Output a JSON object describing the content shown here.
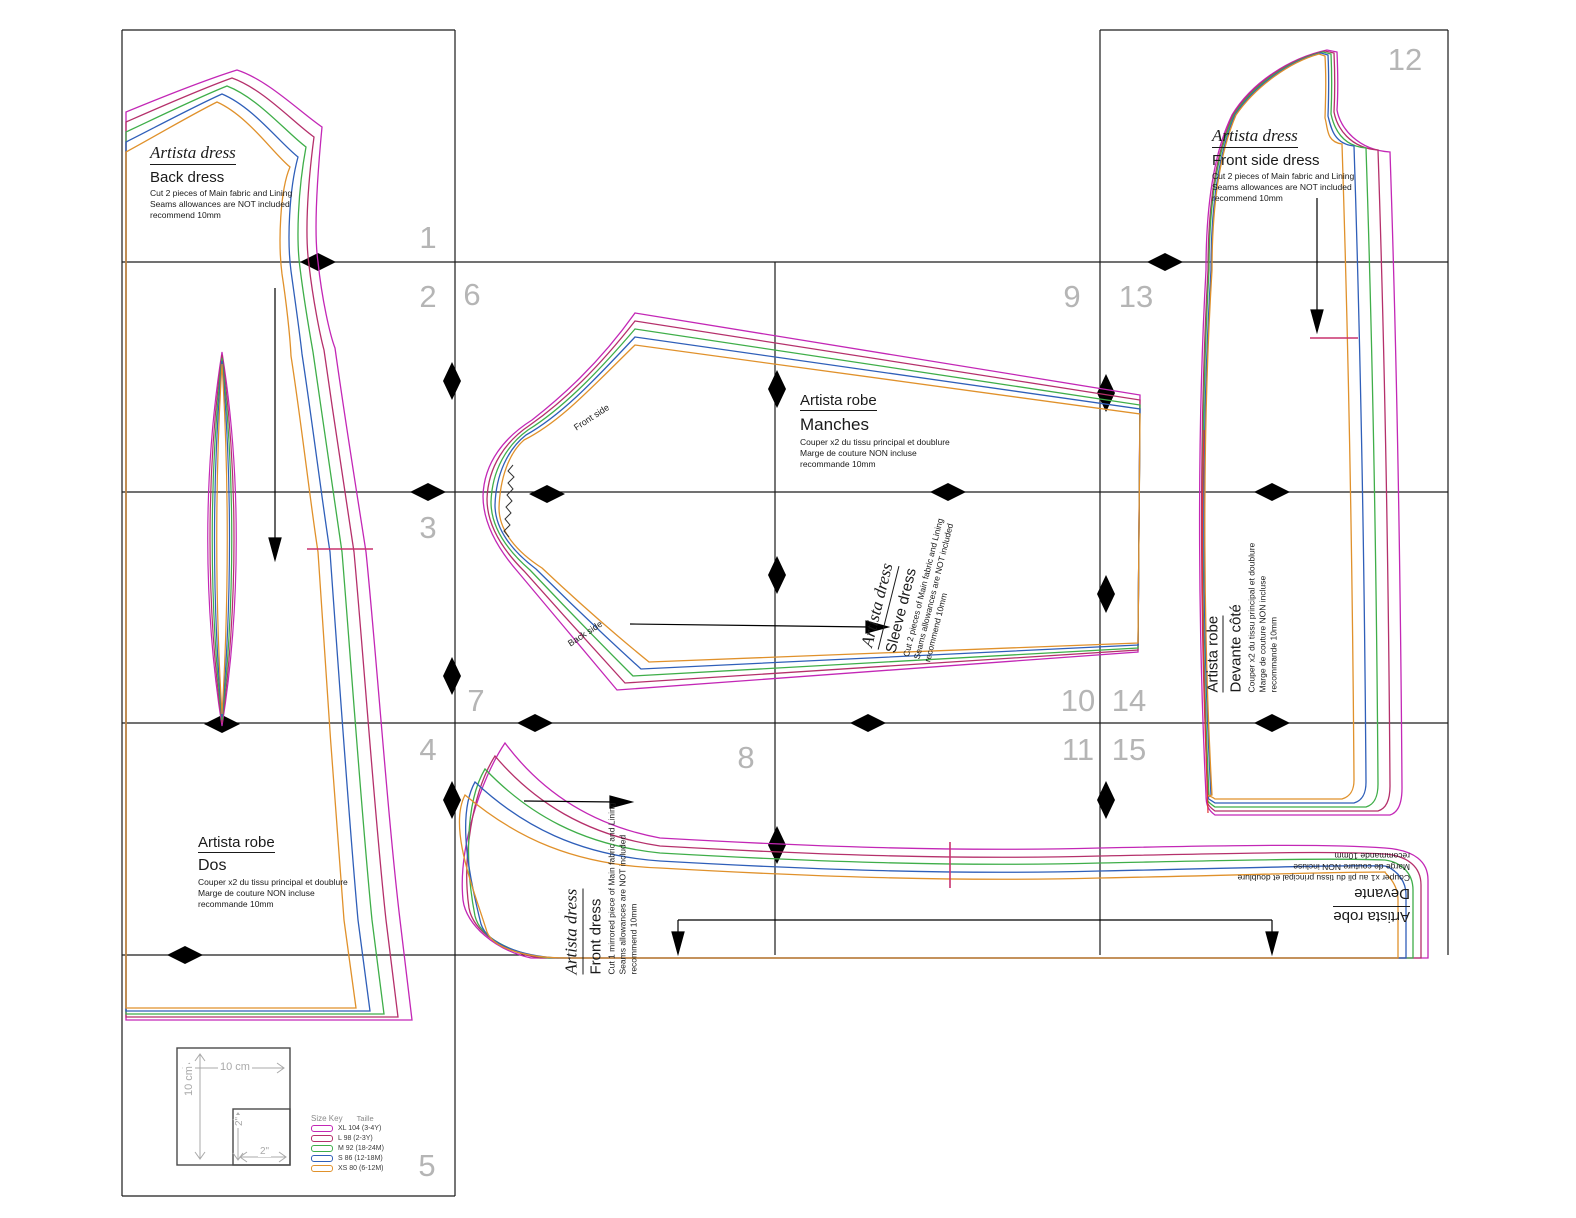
{
  "tiles": {
    "numbers": [
      "1",
      "2",
      "3",
      "4",
      "5",
      "6",
      "7",
      "8",
      "9",
      "10",
      "11",
      "12",
      "13",
      "14",
      "15"
    ]
  },
  "pieces": {
    "back_en": {
      "title": "Artista dress",
      "name": "Back dress",
      "l1": "Cut 2 pieces of Main fabric and Lining",
      "l2": "Seams allowances are NOT included",
      "l3": "recommend 10mm"
    },
    "front_side_en": {
      "title": "Artista dress",
      "name": "Front side dress",
      "l1": "Cut 2 pieces of Main fabric and Lining",
      "l2": "Seams allowances are NOT included",
      "l3": "recommend 10mm"
    },
    "sleeve_fr": {
      "title": "Artista robe",
      "name": "Manches",
      "l1": "Couper x2 du tissu principal et doublure",
      "l2": "Marge de couture NON incluse",
      "l3": "recommande 10mm"
    },
    "sleeve_en": {
      "title": "Artista dress",
      "name": "Sleeve dress",
      "l1": "Cut 2 pieces of Main fabric and Lining",
      "l2": "Seams allowances are NOT included",
      "l3": "recommend 10mm"
    },
    "dos_fr": {
      "title": "Artista robe",
      "name": "Dos",
      "l1": "Couper x2 du tissu principal et doublure",
      "l2": "Marge de couture NON incluse",
      "l3": "recommande 10mm"
    },
    "front_en": {
      "title": "Artista dress",
      "name": "Front dress",
      "l1": "Cut 1 mirrored piece of Main fabric and Lining",
      "l2": "Seams allowances are NOT included",
      "l3": "recommend 10mm"
    },
    "devant_cote_fr": {
      "title": "Artista robe",
      "name": "Devante côté",
      "l1": "Couper x2 du tissu principal et doublure",
      "l2": "Marge de couture NON incluse",
      "l3": "recommande 10mm"
    },
    "devant_fr": {
      "title": "Artista robe",
      "name": "Devante",
      "l1": "Couper x1 au pli du tissu principal et doublure",
      "l2": "Marge de couture NON incluse",
      "l3": "recommande 10mm"
    }
  },
  "sleeve_marks": {
    "front_side": "Front side",
    "back_side": "Back side"
  },
  "legend": {
    "scale_w": "10 cm",
    "scale_h": "10 cm",
    "inner_w": "2\"",
    "inner_h": "2\"",
    "size_key": "Size Key",
    "taille": "Taille",
    "sizes": [
      {
        "label": "XL 104 (3-4Y)",
        "color": "#c327b6"
      },
      {
        "label": "L 98 (2-3Y)",
        "color": "#b5306b"
      },
      {
        "label": "M 92 (18-24M)",
        "color": "#3fae49"
      },
      {
        "label": "S 86 (12-18M)",
        "color": "#2f5fb9"
      },
      {
        "label": "XS 80 (6-12M)",
        "color": "#e0912b"
      }
    ]
  },
  "colors": {
    "size_xl": "#c327b6",
    "size_l": "#b5306b",
    "size_m": "#3fae49",
    "size_s": "#2f5fb9",
    "size_xs": "#e0912b",
    "lining_red": "#e03434",
    "grid": "#1c1c1c",
    "tile_number": "#b5b5b5",
    "tick": "#c9326e"
  }
}
